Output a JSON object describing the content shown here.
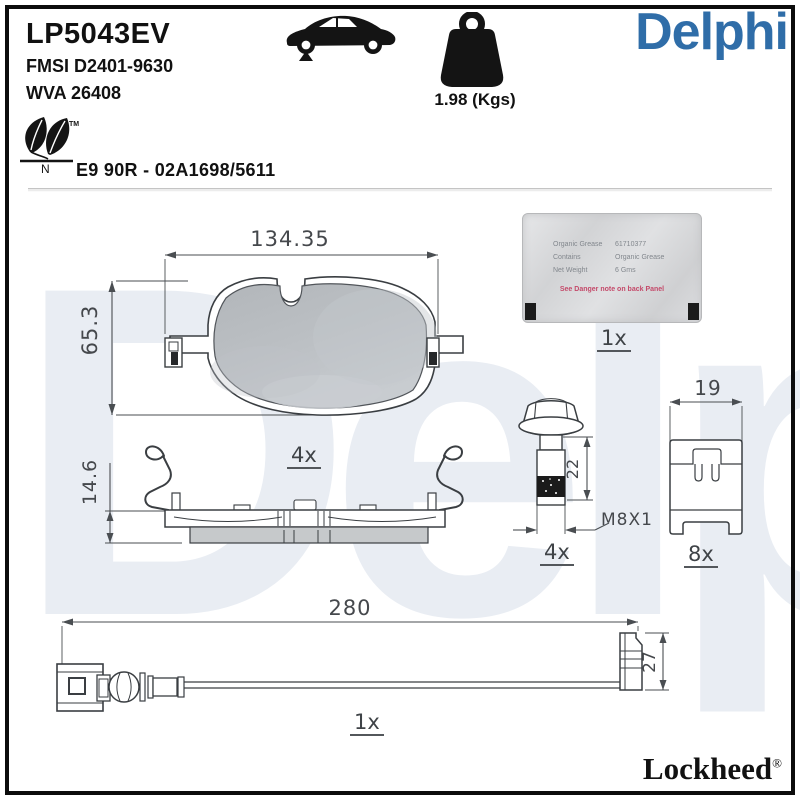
{
  "page": {
    "product_code": "LP5043EV",
    "fmsi_ref": "FMSI D2401-9630",
    "wva_ref": "WVA 26408",
    "brand_logo": "Delphi",
    "weight_label": "1.98 (Kgs)",
    "homologation": "E9 90R - 02A1698/5611",
    "eco_trademark": "TM",
    "eco_letter": "N",
    "watermark": "Delphi",
    "footer_brand": "Lockheed",
    "footer_reg": "®"
  },
  "pad_front_view": {
    "width_mm": "134.35",
    "height_mm": "65.3",
    "quantity": "4x"
  },
  "pad_side_view": {
    "thickness_mm": "14.6"
  },
  "bolt": {
    "length_mm": "22",
    "thread_spec": "M8X1",
    "quantity": "4x"
  },
  "abutment_clip": {
    "width_mm": "19",
    "quantity": "8x"
  },
  "wear_sensor": {
    "length_mm": "280",
    "height_mm": "27",
    "quantity": "1x"
  },
  "grease_sachet": {
    "quantity": "1x",
    "rows": [
      {
        "label": "Organic Grease",
        "value": "61710377"
      },
      {
        "label": "Contains",
        "value": "Organic Grease"
      },
      {
        "label": "Net Weight",
        "value": "6 Gms"
      }
    ],
    "warning": "See Danger note on back Panel"
  },
  "colors": {
    "brand_blue": "#2f6da8",
    "watermark_blue": "#e9edf3",
    "drawing_line": "#43474b",
    "friction_gray": "#b9bdc1"
  }
}
